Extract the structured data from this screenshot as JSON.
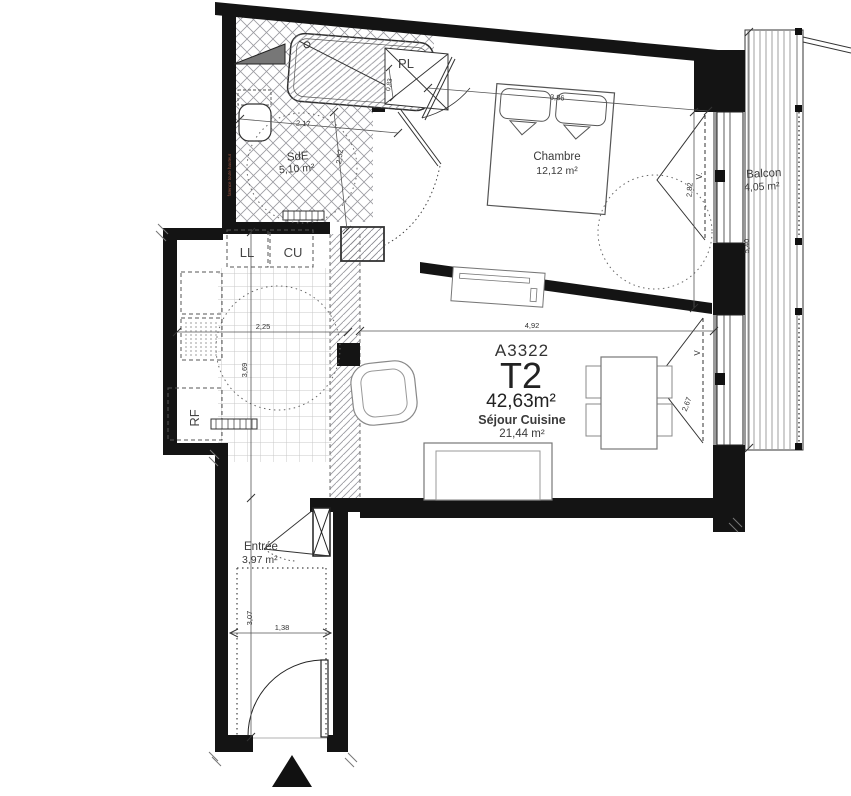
{
  "unit": {
    "code": "A3322",
    "type": "T2",
    "total_area": "42,63m²"
  },
  "rooms": {
    "sejour": {
      "label": "Séjour Cuisine",
      "area": "21,44 m²"
    },
    "chambre": {
      "label": "Chambre",
      "area": "12,12 m²"
    },
    "sde": {
      "label": "SdE",
      "area": "5,10 m²",
      "note": "faïence toute hauteur"
    },
    "balcon": {
      "label": "Balcon",
      "area": "4,05 m²"
    },
    "entree": {
      "label": "Entrée",
      "area": "3,97 m²"
    }
  },
  "fixtures": {
    "washing_machine": "LL",
    "kitchen_unit": "CU",
    "closet": "PL",
    "fridge": "RF",
    "window_chambre": "V.",
    "window_sejour": "V"
  },
  "dimensions": {
    "chambre_width": "3,86",
    "chambre_depth": "2,82",
    "sejour_width": "4,92",
    "sejour_window": "2,67",
    "kitchen_width": "2,25",
    "kitchen_depth": "3,69",
    "entree_width": "1,38",
    "entree_depth": "3,07",
    "sde_width": "2,17",
    "sde_depth": "2,52",
    "closet_depth": "0,83",
    "balcon_length": "5,40"
  },
  "colors": {
    "wall": "#141414",
    "hatch": "#8a8a92",
    "tile": "#c8c8c8",
    "note_text": "#9a523f"
  }
}
